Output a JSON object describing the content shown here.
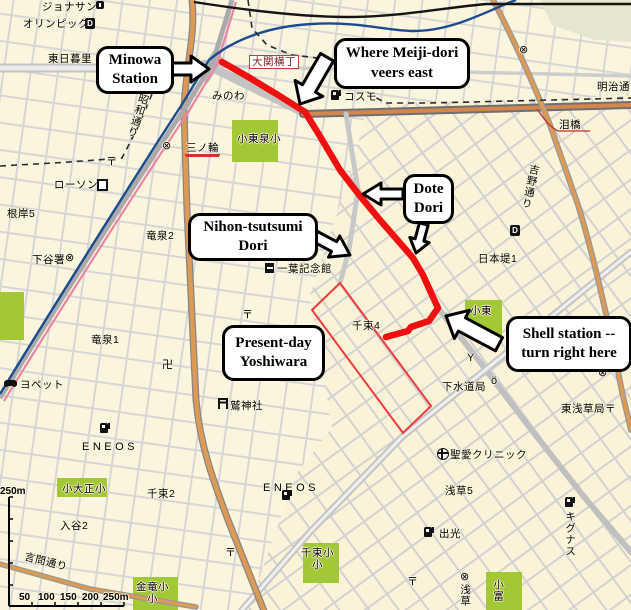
{
  "map": {
    "route": {
      "description": "walking route highlighted in red",
      "color": "#f01010",
      "points": "222,62 250,78 278,95 305,112 318,133 340,170 360,196 380,220 400,243 413,258 423,275 432,295 438,308 429,321 411,327 408,331 386,337"
    },
    "yoshiwara_boundary": {
      "description": "thin red outline of present-day Yoshiwara",
      "color": "#ef3b3b",
      "points": "340,283 312,310 403,433 431,406"
    },
    "callouts": [
      {
        "id": "minowa-station",
        "lines": "Minowa\nStation",
        "x": 96,
        "y": 46,
        "w": 72,
        "h": 42,
        "arrows": [
          {
            "tx": 209,
            "ty": 69,
            "a": 0,
            "len": 42,
            "head": 26,
            "shaft": 12
          }
        ]
      },
      {
        "id": "meiji-veers",
        "lines": "Where Meiji-dori\nveers east",
        "x": 334,
        "y": 38,
        "w": 130,
        "h": 45,
        "arrows": [
          {
            "tx": 300,
            "ty": 104,
            "a": 120,
            "len": 54,
            "head": 32,
            "shaft": 15
          }
        ]
      },
      {
        "id": "dote-dori",
        "lines": "Dote\nDori",
        "x": 403,
        "y": 174,
        "w": 45,
        "h": 44,
        "arrows": [
          {
            "tx": 363,
            "ty": 194,
            "a": 180,
            "len": 40,
            "head": 22,
            "shaft": 10
          },
          {
            "tx": 416,
            "ty": 253,
            "a": 105,
            "len": 30,
            "head": 20,
            "shaft": 9
          }
        ]
      },
      {
        "id": "nihon-tsutsumi",
        "lines": "Nihon-tsutsumi\nDori",
        "x": 188,
        "y": 213,
        "w": 124,
        "h": 42,
        "arrows": [
          {
            "tx": 350,
            "ty": 255,
            "a": 28,
            "len": 40,
            "head": 24,
            "shaft": 11
          }
        ]
      },
      {
        "id": "yoshiwara",
        "lines": "Present-day\nYoshiwara",
        "x": 222,
        "y": 325,
        "w": 97,
        "h": 50,
        "arrows": []
      },
      {
        "id": "shell-station",
        "lines": "Shell station --\nturn right here",
        "x": 506,
        "y": 316,
        "w": 120,
        "h": 50,
        "arrows": [
          {
            "tx": 446,
            "ty": 316,
            "a": -152,
            "len": 60,
            "head": 32,
            "shaft": 15
          }
        ]
      }
    ],
    "labels": [
      {
        "t": "ジョナサン",
        "x": 42,
        "y": 1,
        "name": "label-jonathans"
      },
      {
        "t": "オリンピック",
        "x": 23,
        "y": 18,
        "name": "label-olympic"
      },
      {
        "t": "東日暮里",
        "x": 48,
        "y": 53,
        "name": "label-higashi-nippori"
      },
      {
        "t": "大関横丁",
        "x": 249,
        "y": 55,
        "cls": "redbox",
        "name": "label-ozeki-yokocho"
      },
      {
        "t": "みのわ",
        "x": 212,
        "y": 90,
        "name": "label-minowa-hiragana"
      },
      {
        "t": "明治通り",
        "x": 597,
        "y": 81,
        "name": "label-meiji-dori"
      },
      {
        "t": "コスモ",
        "x": 344,
        "y": 91,
        "name": "label-cosmo-gas"
      },
      {
        "t": "昭和通り",
        "x": 139,
        "y": 92,
        "v": true,
        "r": 18,
        "name": "label-showa-dori"
      },
      {
        "t": "泪橋",
        "x": 559,
        "y": 119,
        "name": "label-namidabashi"
      },
      {
        "t": "小東泉小",
        "x": 237,
        "y": 133,
        "name": "label-tosen-elementary"
      },
      {
        "t": "三ノ輪",
        "x": 186,
        "y": 142,
        "cls": "redline",
        "name": "label-minowa-stop"
      },
      {
        "t": "吉野通り",
        "x": 529,
        "y": 163,
        "v": true,
        "r": 12,
        "name": "label-yoshino-dori"
      },
      {
        "t": "ローソン",
        "x": 54,
        "y": 179,
        "name": "label-lawson"
      },
      {
        "t": "根岸5",
        "x": 7,
        "y": 208,
        "name": "label-negishi-5"
      },
      {
        "t": "竜泉2",
        "x": 146,
        "y": 230,
        "name": "label-ryusen-2"
      },
      {
        "t": "下谷署",
        "x": 32,
        "y": 254,
        "name": "label-shitaya-police"
      },
      {
        "t": "一葉記念館",
        "x": 277,
        "y": 263,
        "name": "label-ichiyo-museum"
      },
      {
        "t": "日本堤1",
        "x": 478,
        "y": 253,
        "name": "label-nihonzutsumi-1"
      },
      {
        "t": "千束4",
        "x": 352,
        "y": 320,
        "name": "label-senzoku-4"
      },
      {
        "t": "小東",
        "x": 470,
        "y": 305,
        "name": "label-kotosen"
      },
      {
        "t": "竜泉1",
        "x": 91,
        "y": 334,
        "name": "label-ryusen-1"
      },
      {
        "t": "ヨペット",
        "x": 20,
        "y": 379,
        "name": "label-yopet"
      },
      {
        "t": "下水道局",
        "x": 442,
        "y": 381,
        "name": "label-sewerage-bureau"
      },
      {
        "t": "東浅草局〒",
        "x": 561,
        "y": 403,
        "name": "label-higashi-asakusa-post"
      },
      {
        "t": "鷲神社",
        "x": 230,
        "y": 400,
        "name": "label-otori-shrine"
      },
      {
        "t": "ENEOS",
        "x": 82,
        "y": 441,
        "cls": "wide",
        "name": "label-eneos-west"
      },
      {
        "t": "ENEOS",
        "x": 263,
        "y": 482,
        "cls": "wide",
        "name": "label-eneos-east"
      },
      {
        "t": "聖愛クリニック",
        "x": 450,
        "y": 449,
        "name": "label-seiai-clinic"
      },
      {
        "t": "小大正小",
        "x": 62,
        "y": 483,
        "name": "label-taisho-elementary"
      },
      {
        "t": "浅草5",
        "x": 445,
        "y": 485,
        "name": "label-asakusa-5"
      },
      {
        "t": "入谷2",
        "x": 60,
        "y": 520,
        "name": "label-iriya-2"
      },
      {
        "t": "千束2",
        "x": 147,
        "y": 488,
        "name": "label-senzoku-2"
      },
      {
        "t": "出光",
        "x": 439,
        "y": 528,
        "name": "label-idemitsu"
      },
      {
        "t": "キグナス",
        "x": 564,
        "y": 511,
        "v": true,
        "name": "label-kygnus"
      },
      {
        "t": "言問通り",
        "x": 26,
        "y": 551,
        "r": 14,
        "name": "label-kototoi-dori"
      },
      {
        "t": "千束小\n小",
        "x": 301,
        "y": 547,
        "cls": "center",
        "name": "label-senzoku-elementary"
      },
      {
        "t": "金竜小\n小",
        "x": 136,
        "y": 581,
        "cls": "center",
        "name": "label-kinryu-elementary"
      },
      {
        "t": "小富",
        "x": 492,
        "y": 579,
        "v": true,
        "name": "label-kotomi"
      },
      {
        "t": "浅草",
        "x": 459,
        "y": 584,
        "v": true,
        "name": "label-asakusa-vert"
      },
      {
        "t": "250m",
        "x": 0,
        "y": 486,
        "cls": "scale",
        "name": "scale-vertical-max"
      },
      {
        "t": "50",
        "x": 19,
        "y": 592,
        "cls": "scale",
        "name": "scale-50"
      },
      {
        "t": "100",
        "x": 38,
        "y": 592,
        "cls": "scale",
        "name": "scale-100"
      },
      {
        "t": "150",
        "x": 60,
        "y": 592,
        "cls": "scale",
        "name": "scale-150"
      },
      {
        "t": "200",
        "x": 82,
        "y": 592,
        "cls": "scale",
        "name": "scale-200"
      },
      {
        "t": "250m",
        "x": 103,
        "y": 592,
        "cls": "scale",
        "name": "scale-250m"
      }
    ],
    "icons": [
      {
        "type": "police",
        "x": 162,
        "y": 141
      },
      {
        "type": "police",
        "x": 519,
        "y": 45
      },
      {
        "type": "police",
        "x": 598,
        "y": 368
      },
      {
        "type": "police",
        "x": 312,
        "y": 364
      },
      {
        "type": "police",
        "x": 65,
        "y": 253
      },
      {
        "type": "police",
        "x": 460,
        "y": 572
      },
      {
        "type": "post",
        "x": 106,
        "y": 157
      },
      {
        "type": "post",
        "x": 242,
        "y": 310
      },
      {
        "type": "post",
        "x": 225,
        "y": 548
      },
      {
        "type": "post",
        "x": 407,
        "y": 577
      },
      {
        "type": "gas",
        "x": 331,
        "y": 90
      },
      {
        "type": "gas",
        "x": 100,
        "y": 423
      },
      {
        "type": "gas",
        "x": 282,
        "y": 490
      },
      {
        "type": "gas",
        "x": 424,
        "y": 527
      },
      {
        "type": "gas",
        "x": 565,
        "y": 497
      },
      {
        "type": "d",
        "x": 85,
        "y": 18
      },
      {
        "type": "d",
        "x": 510,
        "y": 225
      },
      {
        "type": "museum",
        "x": 265,
        "y": 263
      },
      {
        "type": "restaurant",
        "x": 96,
        "y": 1
      },
      {
        "type": "conv",
        "x": 97,
        "y": 179
      },
      {
        "type": "car",
        "x": 4,
        "y": 380
      },
      {
        "type": "torii",
        "x": 218,
        "y": 398
      },
      {
        "type": "hospital",
        "x": 437,
        "y": 448
      },
      {
        "type": "temple",
        "x": 162,
        "y": 360
      },
      {
        "type": "fire",
        "x": 467,
        "y": 353
      },
      {
        "type": "face",
        "x": 491,
        "y": 376
      }
    ],
    "icon_glyphs": {
      "police": "⊗",
      "post": "〒",
      "temple": "卍",
      "fire": "Y",
      "face": "ö",
      "d": "D"
    },
    "scale": {
      "vertical_label": "250m",
      "horizontal_labels": [
        "50",
        "100",
        "150",
        "200",
        "250m"
      ]
    }
  }
}
